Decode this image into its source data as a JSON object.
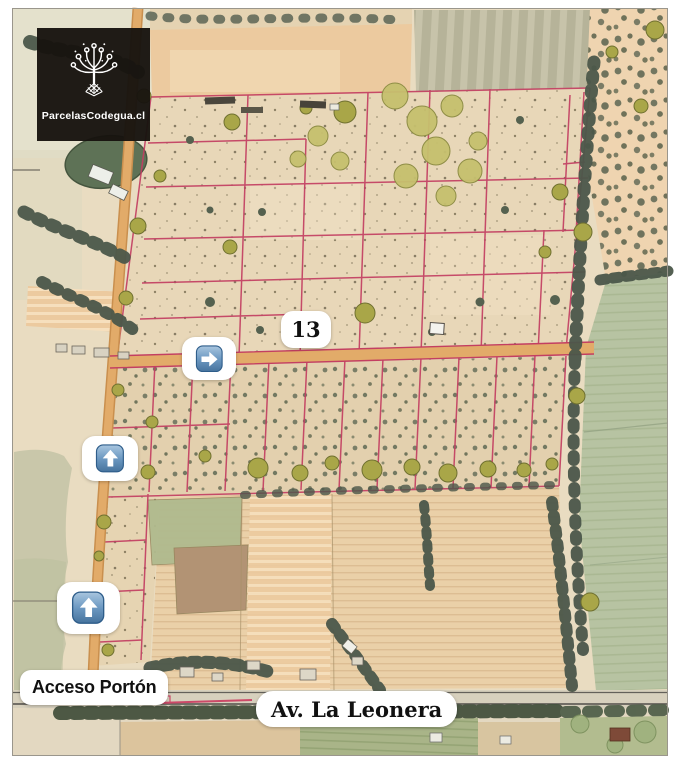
{
  "logo": {
    "brand": "ParcelasCodegua.cl",
    "icon": "ornamental-tree-icon",
    "background": "#17130f",
    "text_color": "#ffffff"
  },
  "map": {
    "style": "hand-drawn watercolor aerial parcel masterplan",
    "parcel_label": "13",
    "access_label": "Acceso Portón",
    "road_label": "Av. La Leonera",
    "markers": [
      {
        "icon": "arrow-right-icon"
      },
      {
        "icon": "arrow-up-icon"
      },
      {
        "icon": "arrow-up-icon"
      }
    ],
    "colors": {
      "parcel_boundary": "#c33f62",
      "road_tan": "#e2ab69",
      "terrain_beige": "#e9dcc1",
      "crop_field_sage": "#b7c3a2",
      "tree_olive": "#a9a648",
      "scrub_dark": "#4b574a",
      "marker_blue": "#5381ad",
      "label_background": "#ffffff",
      "label_text": "#111111"
    }
  }
}
